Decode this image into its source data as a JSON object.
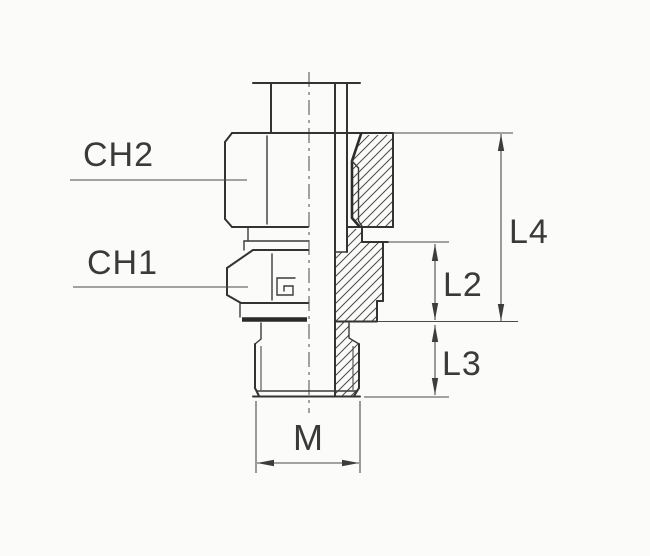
{
  "drawing": {
    "type": "technical-section-drawing",
    "subject": "male stud coupling fitting with swivel nut, half section view",
    "callouts": {
      "ch2": "CH2",
      "ch1": "CH1"
    },
    "dimensions": {
      "l4": "L4",
      "l2": "L2",
      "l3": "L3",
      "m": "M"
    },
    "colors": {
      "background": "#fbfbfa",
      "line": "#333333",
      "dimension_line": "#4a4a4a",
      "hatch": "#4a4a4a",
      "label_text": "#3a3a3a"
    }
  }
}
